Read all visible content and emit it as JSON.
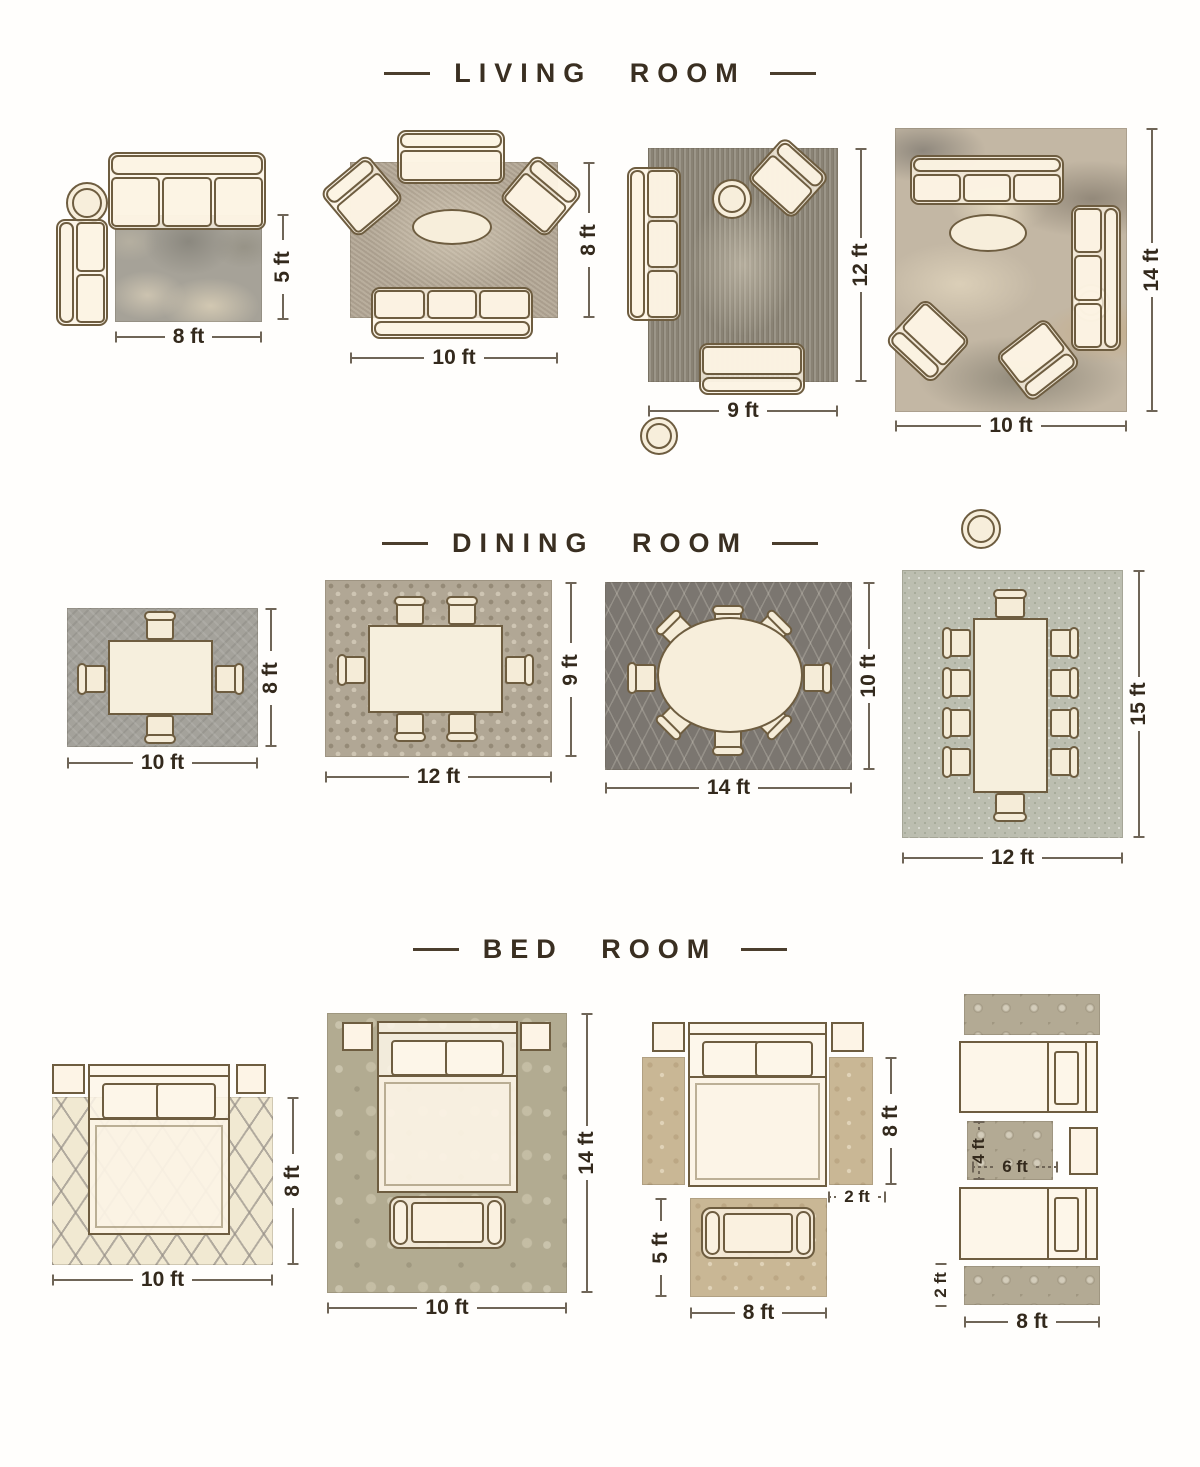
{
  "poster": {
    "type": "rug-size-guide",
    "colors": {
      "background": "#fffefc",
      "title_text": "#3a2f21",
      "dimension_text": "#33291c",
      "furniture_fill": "#fbf2e1",
      "furniture_outline": "#6e5d40"
    }
  },
  "sections": [
    {
      "title": "LIVING ROOM",
      "layouts": [
        {
          "rug": "mottled grey rug",
          "width": "8 ft",
          "height": "5 ft",
          "furniture": [
            "3-seat sofa",
            "round side table",
            "2-seat sofa"
          ]
        },
        {
          "rug": "taupe rug",
          "width": "10 ft",
          "height": "8 ft",
          "furniture": [
            "2-seat sofa",
            "armchair",
            "armchair",
            "oval coffee table",
            "3-seat sofa"
          ]
        },
        {
          "rug": "distressed vintage rug",
          "width": "9 ft",
          "height": "12 ft",
          "furniture": [
            "round side table",
            "armchair",
            "3-seat sofa",
            "round side table",
            "2-seat sofa"
          ]
        },
        {
          "rug": "abstract rug",
          "width": "10 ft",
          "height": "14 ft",
          "furniture": [
            "3-seat sofa",
            "round side table",
            "3-seat sofa",
            "oval coffee table",
            "armchair",
            "armchair",
            "round side table"
          ]
        }
      ]
    },
    {
      "title": "DINING ROOM",
      "layouts": [
        {
          "rug": "grey weave rug",
          "width": "10 ft",
          "height": "8 ft",
          "furniture": [
            "rectangular dining table",
            "4 chairs"
          ]
        },
        {
          "rug": "mosaic rug",
          "width": "12 ft",
          "height": "9 ft",
          "furniture": [
            "rectangular dining table",
            "6 chairs"
          ]
        },
        {
          "rug": "dark lattice rug",
          "width": "14 ft",
          "height": "10 ft",
          "furniture": [
            "oval dining table",
            "8 chairs"
          ]
        },
        {
          "rug": "light tweed rug",
          "width": "12 ft",
          "height": "15 ft",
          "furniture": [
            "rectangular dining table",
            "10 chairs"
          ]
        }
      ]
    },
    {
      "title": "BED ROOM",
      "layouts": [
        {
          "rug": "cream trellis rug",
          "width": "10 ft",
          "height": "8 ft",
          "furniture": [
            "queen bed",
            "2 nightstands"
          ]
        },
        {
          "rug": "damask rug",
          "width": "10 ft",
          "height": "14 ft",
          "furniture": [
            "queen bed",
            "2 nightstands",
            "bench"
          ]
        },
        {
          "labels": {
            "bedside_runner_height": "8 ft",
            "bedside_runner_width": "2 ft",
            "front_rug_height": "5 ft",
            "front_rug_width": "8 ft"
          },
          "furniture": [
            "queen bed",
            "2 nightstands",
            "2 bedside runner rugs",
            "bench",
            "front rug"
          ]
        },
        {
          "labels": {
            "center_rug_height": "4 ft",
            "center_rug_width": "6 ft",
            "runner_height": "2 ft",
            "runner_width": "8 ft"
          },
          "furniture": [
            "twin bed",
            "twin bed",
            "nightstand",
            "2 runner rugs",
            "center rug"
          ]
        }
      ]
    }
  ]
}
